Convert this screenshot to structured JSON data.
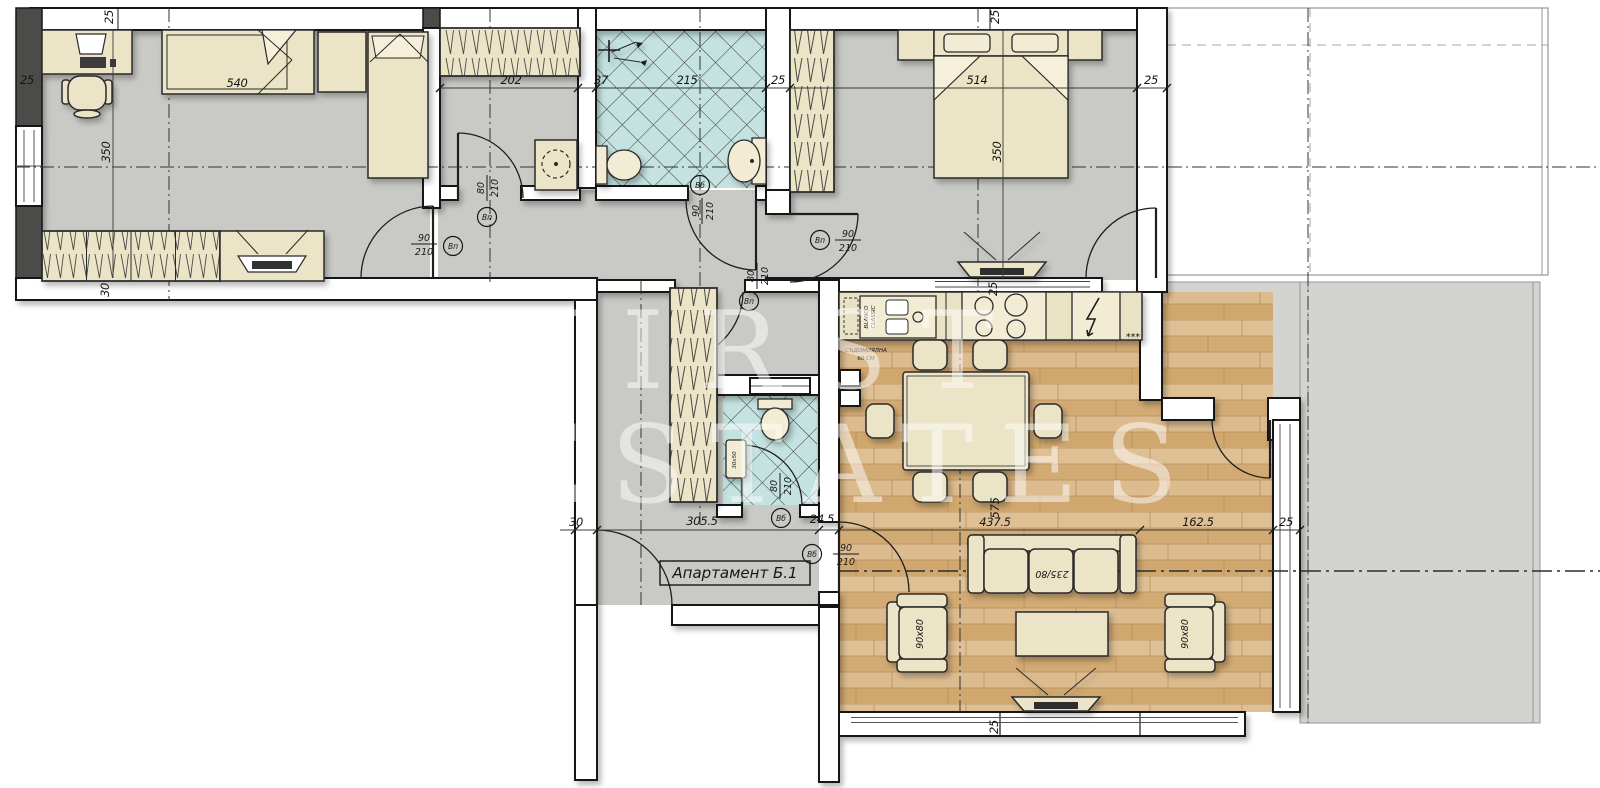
{
  "title": "Апартамент Б.1",
  "watermark": {
    "line1": "FIRST",
    "line2": "ESTATES"
  },
  "colors": {
    "floor_gray": "#c9c9c5",
    "terrace_gray": "#d3d3cf",
    "bath_teal": "#c3e2e0",
    "wood_base": "#d9b98a",
    "wall_dark": "#4b4b49",
    "line_black": "#161616",
    "furniture_cream": "#ece4c6"
  },
  "dims": {
    "d25": "25",
    "d30": "30",
    "d37": "37",
    "d202": "202",
    "d215": "215",
    "d350": "350",
    "d540": "540",
    "d514": "514",
    "d305_5": "305.5",
    "d24_5": "24.5",
    "d437_5": "437.5",
    "d162_5": "162.5",
    "d575": "575"
  },
  "doors": {
    "w80": "80",
    "w90": "90",
    "h210": "210",
    "type_vp": "Вп",
    "type_vb": "Вб"
  },
  "furniture": {
    "sofa": "235/80",
    "armchair": "90x80",
    "wc_sink": "30x50"
  },
  "kitchen": {
    "sink_brand": "BLANCO",
    "sink_model": "CLASSIC",
    "dishwasher_line1": "СЪДОМИЯЛНА",
    "dishwasher_line2": "60 СМ",
    "freezer_marks": "***"
  }
}
